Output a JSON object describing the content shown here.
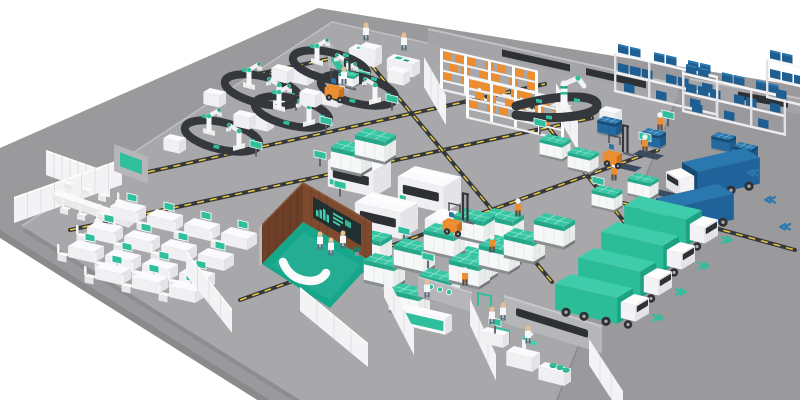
{
  "scene": {
    "title": "Smart factory isometric overview",
    "type": "3d-isometric-illustration",
    "background": "#ffffff"
  },
  "colors": {
    "floor": "#a8a8ab",
    "apron": "#9a9a9d",
    "slab_edge": "#bfbfc2",
    "conveyor": "#34373b",
    "hazard": "#e9c93c",
    "teal": "#2fbf9d",
    "teal_d": "#1da183",
    "teal_l": "#43cfae",
    "teal_floor": "#14a78a",
    "blue": "#1f5e90",
    "blue_d": "#174a73",
    "blue_l": "#2a78b0",
    "orange": "#ec8d2f",
    "orange_d": "#cf711c",
    "wood": "#6e3f27",
    "wood_l": "#7d4a2e",
    "wall": "#b6b6b9",
    "screen": "#203030",
    "white": "#f7f7f9"
  },
  "inventory": {
    "robot_assembly_cells": 5,
    "cnc_machines": 4,
    "u_conveyor_robots": 1,
    "pallet_racks_orange": 2,
    "bin_racks_blue": 3,
    "office_desks": 15,
    "meeting_chairs": 8,
    "teal_pallet_stacks": 22,
    "blue_bin_stacks": 4,
    "forklifts": 3,
    "workers": 16,
    "inbound_trucks_blue": 2,
    "outbound_trucks_teal": 4,
    "control_rooms": 1,
    "reception_desks": 1,
    "work_tables": 3,
    "info_kiosks": 8,
    "hazard_lanes": 8
  },
  "zones": [
    {
      "name": "robot-assembly-cells"
    },
    {
      "name": "pallet-racking-orange"
    },
    {
      "name": "u-conveyor-station"
    },
    {
      "name": "bin-racks-receiving"
    },
    {
      "name": "inbound-truck-dock"
    },
    {
      "name": "cnc-machining"
    },
    {
      "name": "agv-lanes"
    },
    {
      "name": "office-area"
    },
    {
      "name": "control-room"
    },
    {
      "name": "reception"
    },
    {
      "name": "work-tables"
    },
    {
      "name": "shipping-stacks"
    },
    {
      "name": "outbound-truck-dock"
    }
  ]
}
